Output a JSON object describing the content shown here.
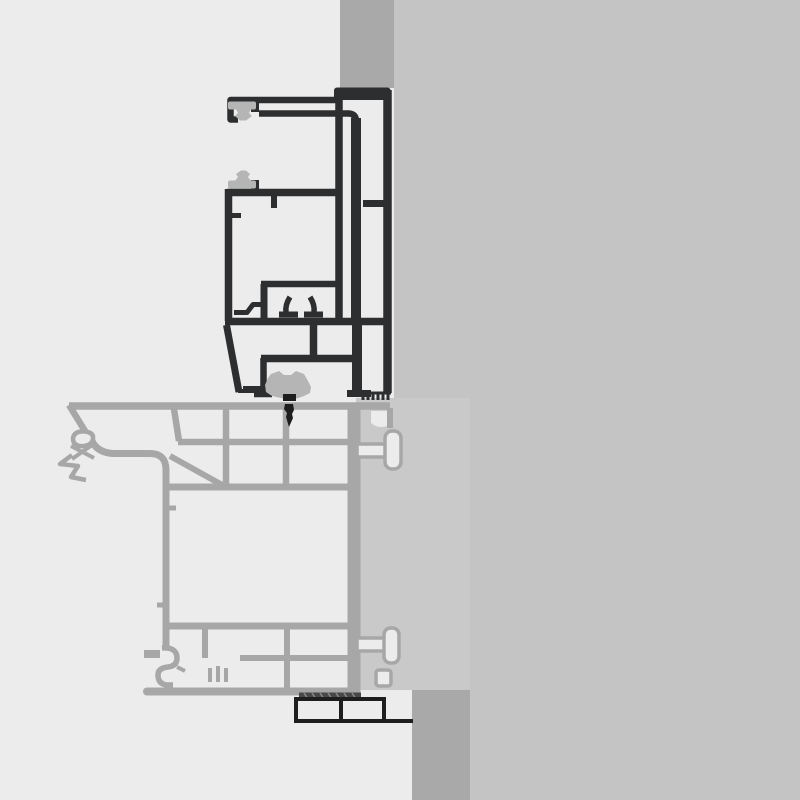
{
  "title": "Window frame replacement cross-section detail",
  "description": "Technical section drawing: new dark-outlined aluminium frame profile on top, existing light-gray PVC frame profile below, set against a masonry wall with plaster panel; rubber gaskets, foam tape and a packer block shown. No visible text or labels in the drawing.",
  "colors": {
    "bg-light": "#ececec",
    "bg-right": "#c3c4c3",
    "wall-dark": "#a9a9a9",
    "panel": "#c9c9c9",
    "stroke-gray": "#a7a7a7",
    "stroke-dark": "#2d2e30",
    "gasket": "#b4b5b4",
    "black-part": "#1e1e1f"
  },
  "legend": {
    "background_left": "interior side (light)",
    "background_right": "exterior masonry wall (medium gray)",
    "wall_strip_top": "masonry reveal above frame (dark gray)",
    "wall_block_bottom": "masonry sill below frame (dark gray)",
    "wall_panel": "plaster / wall panel beside existing frame",
    "new_frame_profile": "new frame profile (dark outline)",
    "existing_frame_profile": "existing frame profile (gray outline)",
    "gaskets": "sealing gaskets (gray rubber)",
    "foam_tape": "serrated compression foam tape",
    "packer_block": "packer / spacer block with sealing tape",
    "sealant_drop": "sealant / screw tip marker"
  }
}
